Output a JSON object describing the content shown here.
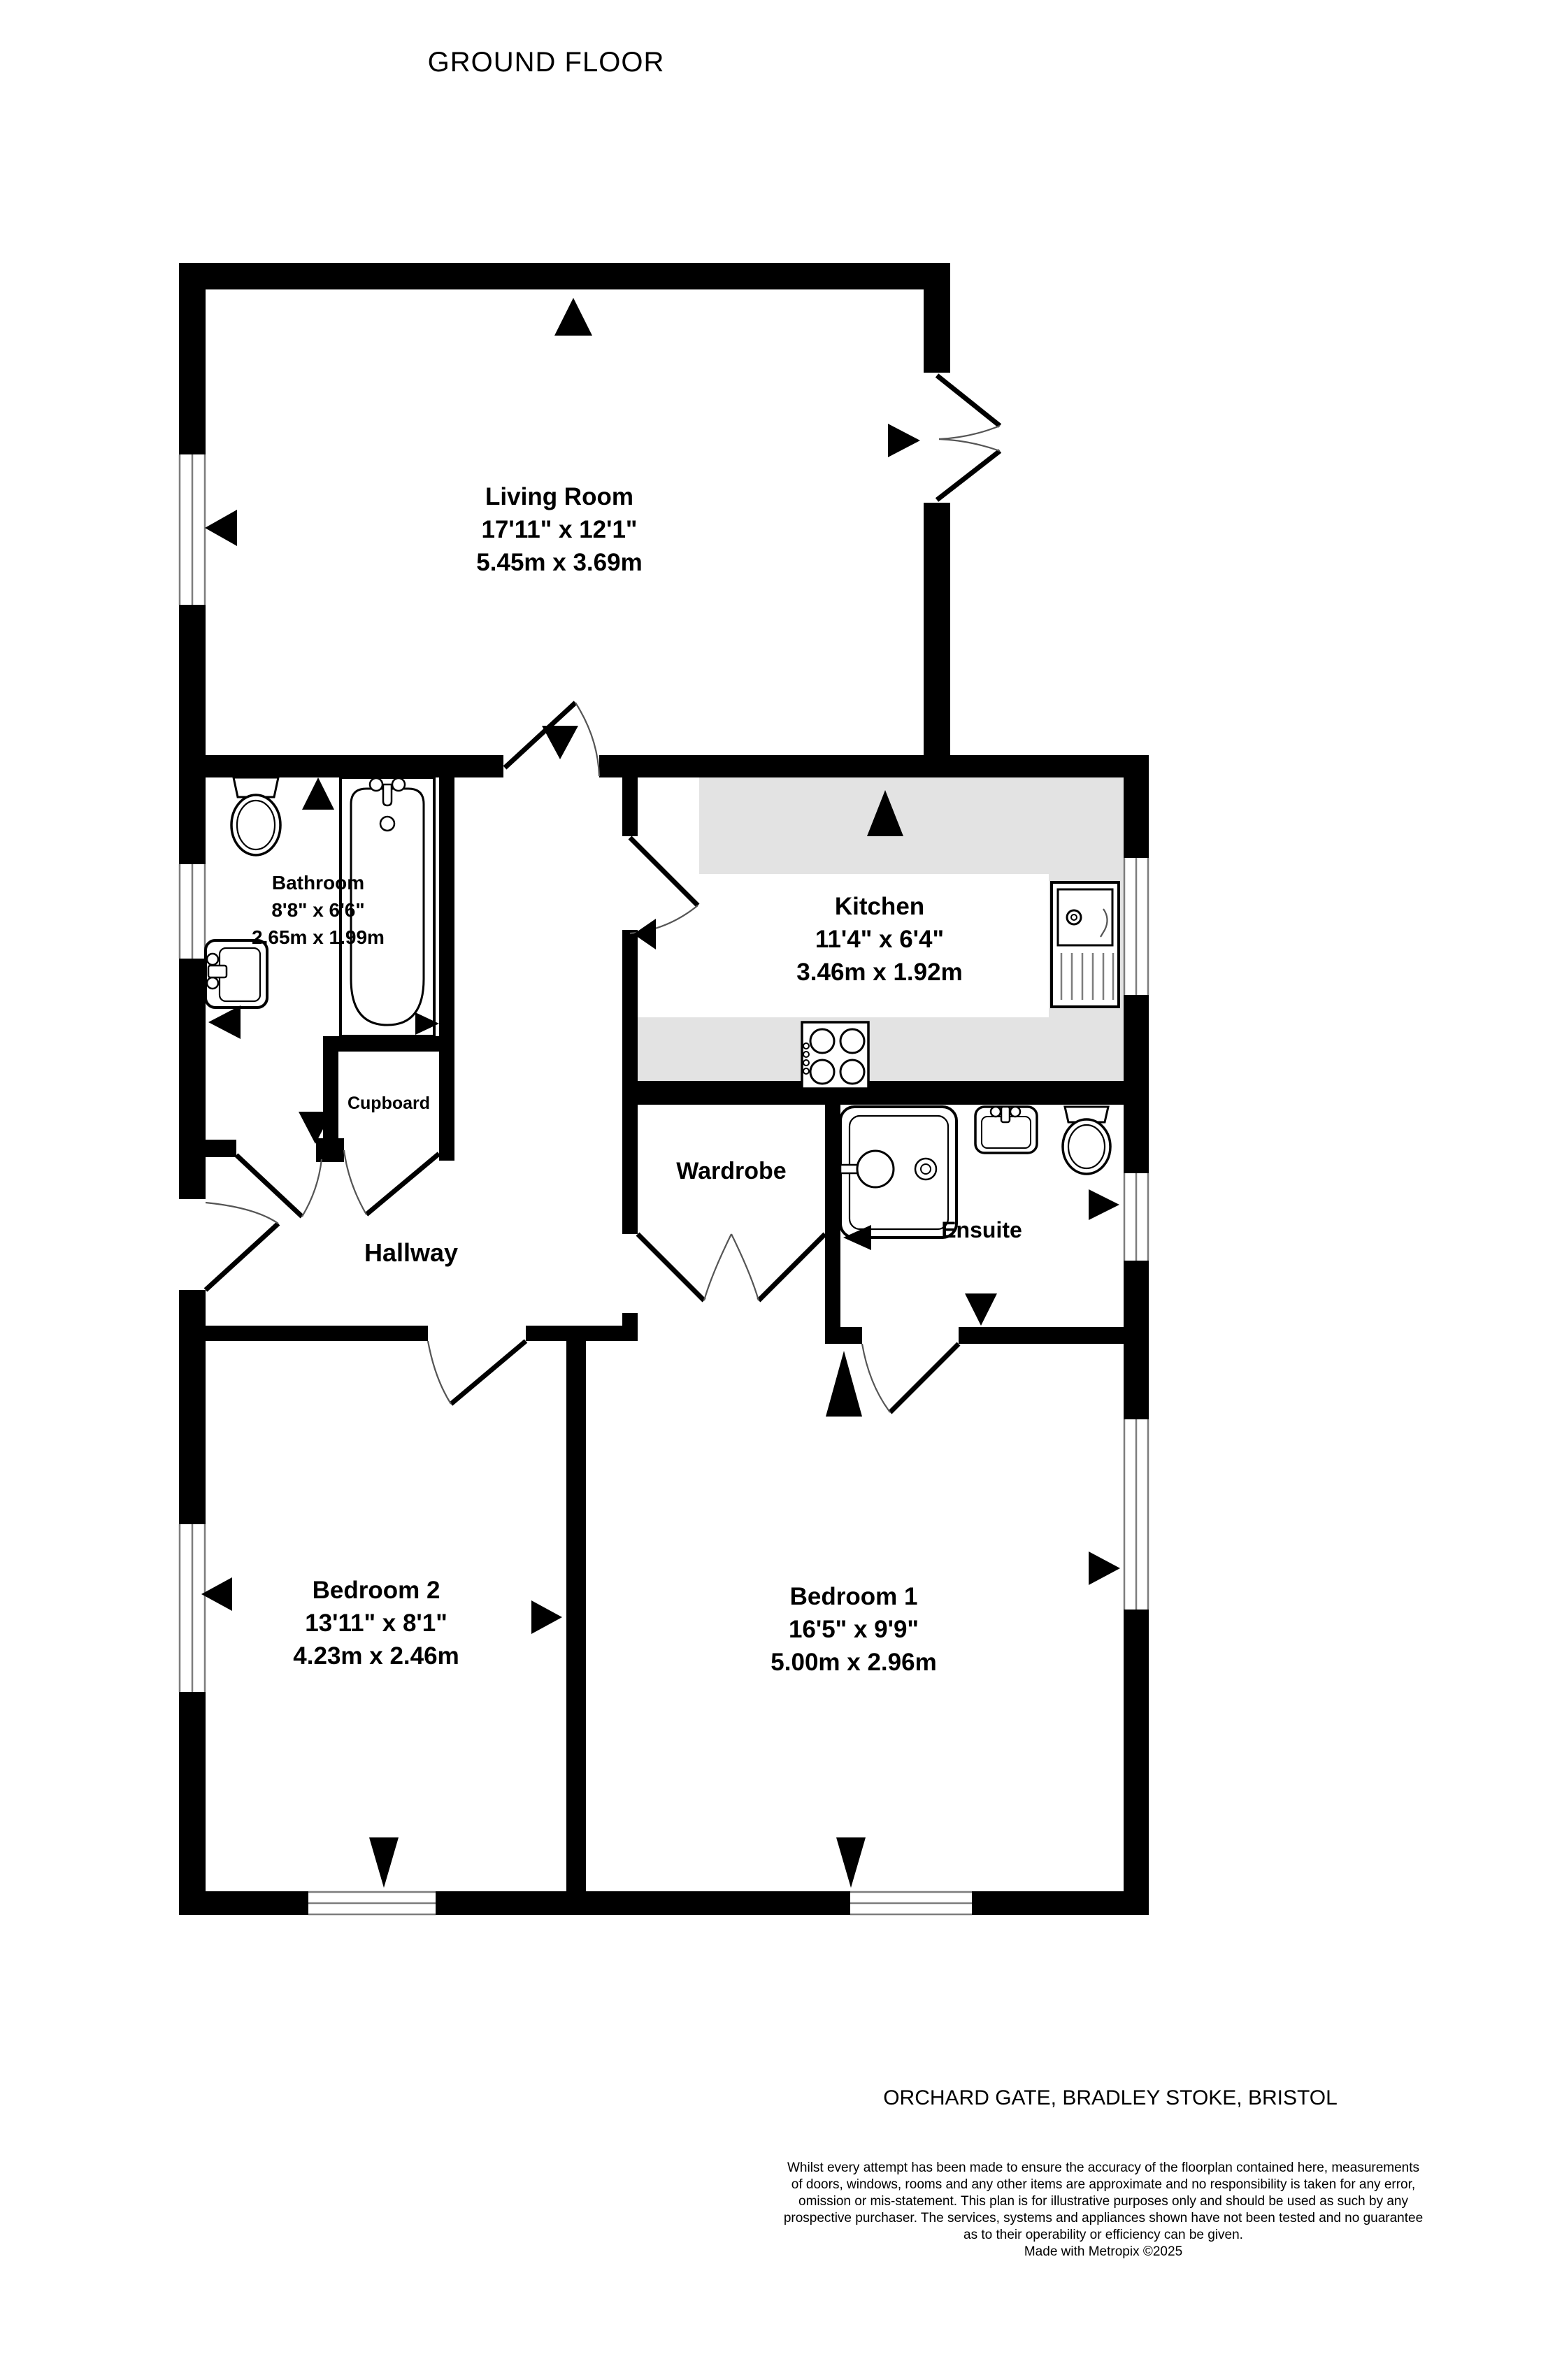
{
  "title": "GROUND FLOOR",
  "address": "ORCHARD GATE, BRADLEY STOKE, BRISTOL",
  "rooms": {
    "living_room": {
      "name": "Living Room",
      "imperial": "17'11\"  x 12'1\"",
      "metric": "5.45m  x 3.69m"
    },
    "bathroom": {
      "name": "Bathroom",
      "imperial": "8'8\"  x 6'6\"",
      "metric": "2.65m  x 1.99m"
    },
    "kitchen": {
      "name": "Kitchen",
      "imperial": "11'4\"  x 6'4\"",
      "metric": "3.46m  x 1.92m"
    },
    "bedroom2": {
      "name": "Bedroom 2",
      "imperial": "13'11\"  x 8'1\"",
      "metric": "4.23m  x 2.46m"
    },
    "bedroom1": {
      "name": "Bedroom 1",
      "imperial": "16'5\"  x 9'9\"",
      "metric": "5.00m  x 2.96m"
    },
    "cupboard": {
      "name": "Cupboard"
    },
    "hallway": {
      "name": "Hallway"
    },
    "wardrobe": {
      "name": "Wardrobe"
    },
    "ensuite": {
      "name": "Ensuite"
    }
  },
  "disclaimer": {
    "lines": [
      "Whilst every attempt has been made to ensure the accuracy of the floorplan contained here, measurements",
      "of doors, windows, rooms and any other items are approximate and no responsibility is taken for any error,",
      "omission or mis-statement. This plan is for illustrative purposes only and should be used as such by any",
      "prospective purchaser. The services, systems and appliances shown have not been tested and no guarantee",
      "as to their operability or efficiency can be given.",
      "Made with Metropix ©2025"
    ]
  },
  "colors": {
    "wall": "#000000",
    "counter": "#e3e3e3",
    "window_line": "#7d7d7d",
    "door_arc": "#555555",
    "background": "#ffffff"
  }
}
